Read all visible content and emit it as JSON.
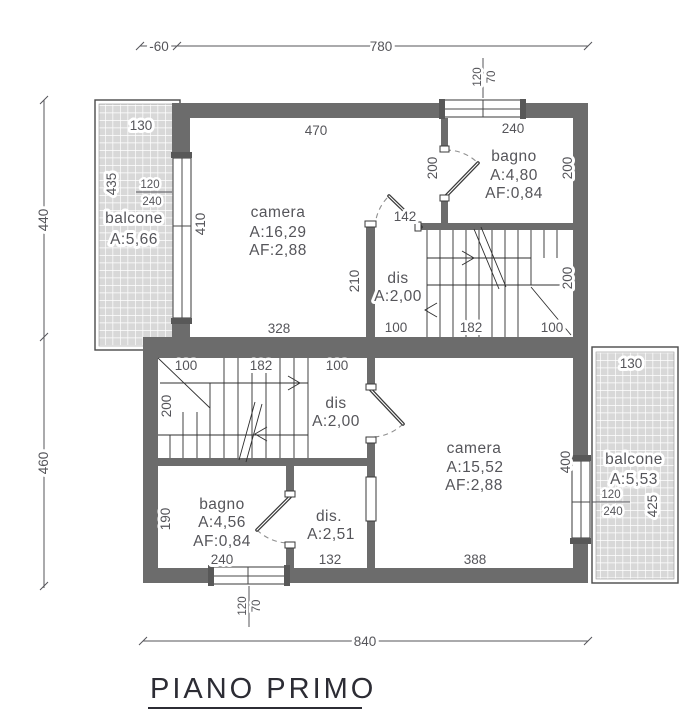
{
  "title": {
    "text": "PIANO PRIMO"
  },
  "colors": {
    "wall": "#6c6c6c",
    "hatch": "#d8d8d8",
    "ink": "#55555a"
  },
  "overall": {
    "top_offset": "-60",
    "top_width": "780",
    "left_upper": "440",
    "left_lower": "460",
    "bottom_width": "840"
  },
  "upper": {
    "camera": {
      "name": "camera",
      "area": "A:16,29",
      "af": "AF:2,88",
      "dim_top": "470",
      "dim_left": "410",
      "dim_bottom": "328",
      "dim_right": "210"
    },
    "bagno": {
      "name": "bagno",
      "area": "A:4,80",
      "af": "AF:0,84",
      "dim_top": "240",
      "dim_left": "200",
      "dim_right": "200",
      "win_w": "120",
      "win_h": "70"
    },
    "dis": {
      "name": "dis",
      "area": "A:2,00",
      "door_dim": "142"
    },
    "stairs": {
      "d1": "100",
      "d2": "182",
      "d3": "100",
      "height": "200"
    },
    "balcone": {
      "name": "balcone",
      "area": "A:5,66",
      "dim_top": "130",
      "dim_side": "435",
      "win_a": "120",
      "win_b": "240"
    }
  },
  "lower": {
    "stairs": {
      "d1": "100",
      "d2": "182",
      "d3": "100",
      "height": "200"
    },
    "dis": {
      "name": "dis",
      "area": "A:2,00"
    },
    "bagno": {
      "name": "bagno",
      "area": "A:4,56",
      "af": "AF:0,84",
      "dim_left": "190",
      "dim_bottom": "240",
      "win_w": "120",
      "win_h": "70"
    },
    "dis2": {
      "name": "dis.",
      "area": "A:2,51",
      "dim_bottom": "132"
    },
    "camera": {
      "name": "camera",
      "area": "A:15,52",
      "af": "AF:2,88",
      "dim_bottom": "388",
      "dim_right": "400"
    },
    "balcone": {
      "name": "balcone",
      "area": "A:5,53",
      "dim_top": "130",
      "dim_side": "425",
      "win_a": "120",
      "win_b": "240"
    }
  }
}
